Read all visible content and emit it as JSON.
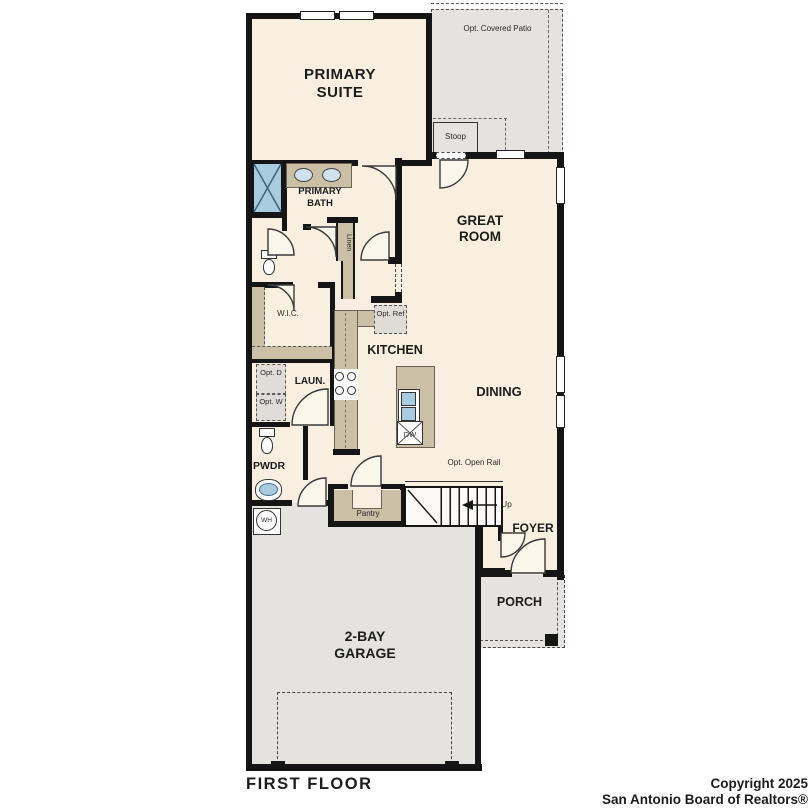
{
  "plan": {
    "floor_label": "FIRST FLOOR",
    "rooms": {
      "primary_suite": "PRIMARY SUITE",
      "primary_bath": "PRIMARY BATH",
      "wic": "W.I.C.",
      "linen": "Linen",
      "laundry": "LAUN.",
      "opt_dryer": "Opt. D",
      "opt_washer": "Opt. W",
      "powder": "PWDR",
      "water_heater": "WH",
      "kitchen": "KITCHEN",
      "opt_ref": "Opt. Ref",
      "dishwasher": "DW",
      "great_room": "GREAT ROOM",
      "dining": "DINING",
      "pantry": "Pantry",
      "stairs_up": "Up",
      "opt_open_rail": "Opt. Open Rail",
      "foyer": "FOYER",
      "porch": "PORCH",
      "garage": "2-BAY GARAGE",
      "stoop": "Stoop",
      "opt_covered_patio": "Opt. Covered Patio"
    },
    "copyright_line1": "Copyright 2025",
    "copyright_line2": "San Antonio Board of Realtors®",
    "colors": {
      "room_fill": "#f8efe0",
      "exterior_fill": "#e4e3e0",
      "cabinet_fill": "#cbbfa5",
      "fixture_blue": "#a9cbdf",
      "wall": "#151515"
    },
    "icons": {
      "shower": "crossed-square",
      "dishwasher": "crossed-square",
      "stairs": "treads-with-up-arrow",
      "doors": "quarter-circle-swing"
    }
  }
}
